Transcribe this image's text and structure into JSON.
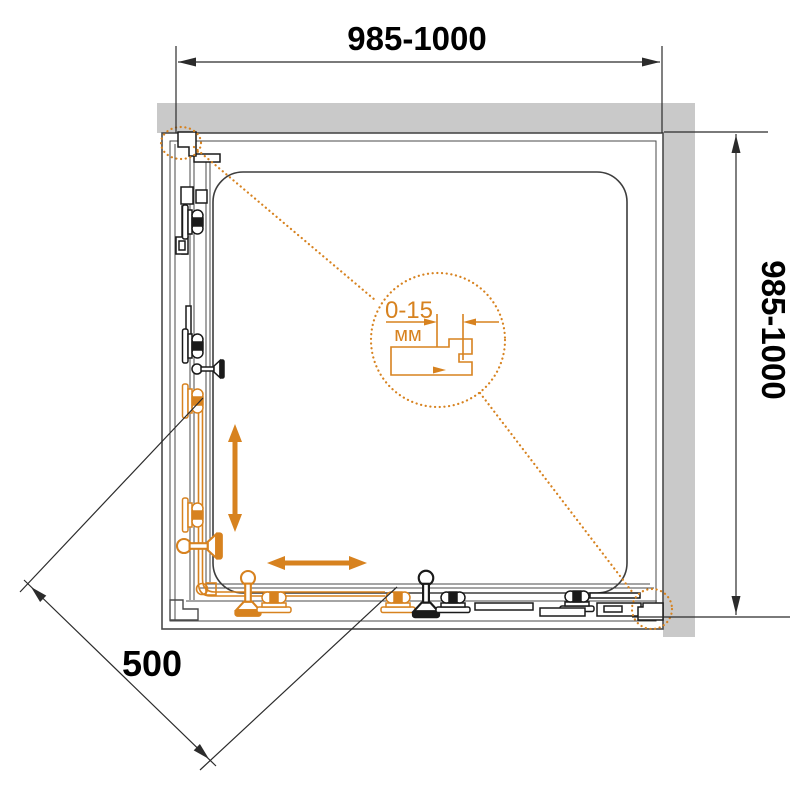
{
  "drawing_title": "shower-enclosure-square-plan",
  "colors": {
    "accent_orange": "#D7821F",
    "wall_gray": "#C9C9C9",
    "line_dark": "#2B2B2B",
    "frame_gray": "#4A4A4A",
    "hardware_black": "#1A1A1A"
  },
  "dimensions": {
    "top": {
      "label": "985-1000"
    },
    "right": {
      "label": "985-1000"
    },
    "diagonal": {
      "label": "500"
    }
  },
  "detail_callout": {
    "range": "0-15",
    "unit": "мм"
  }
}
